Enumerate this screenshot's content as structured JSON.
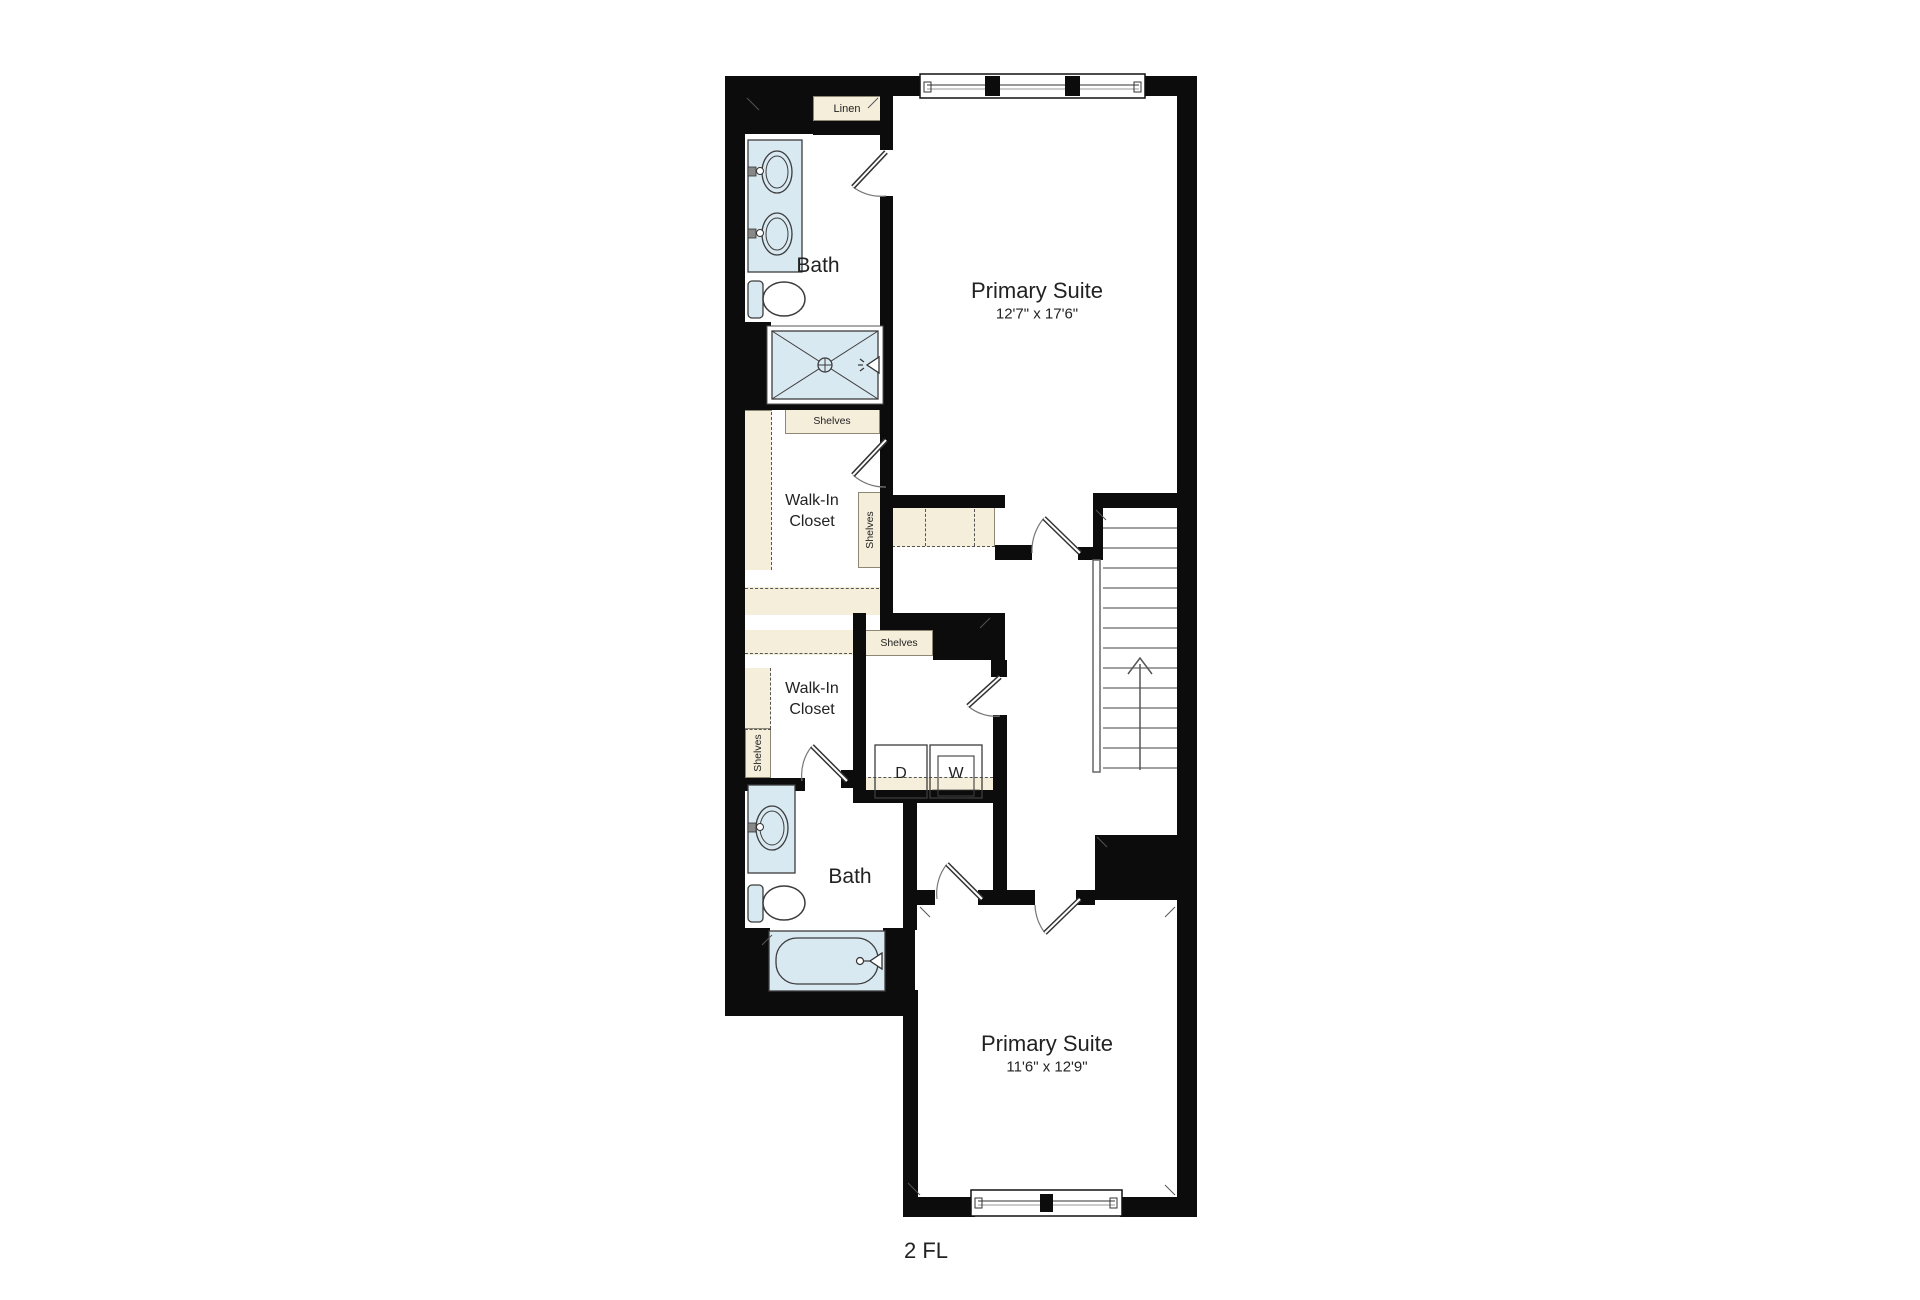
{
  "floor_label": "2 FL",
  "rooms": {
    "primary_suite_top": {
      "name": "Primary Suite",
      "dimensions": "12'7\" x 17'6\""
    },
    "primary_suite_bottom": {
      "name": "Primary Suite",
      "dimensions": "11'6\" x 12'9\""
    },
    "bath_top": {
      "name": "Bath"
    },
    "bath_bottom": {
      "name": "Bath"
    },
    "walk_in_closet_top": {
      "name": "Walk-In Closet"
    },
    "walk_in_closet_bottom": {
      "name": "Walk-In Closet"
    }
  },
  "labels": {
    "linen": "Linen",
    "shelves": "Shelves",
    "dryer": "D",
    "washer": "W"
  },
  "icons": {
    "stairs_direction": "up-arrow",
    "shower_head": "spray-left",
    "tub_faucet": "spray-left",
    "drain": "circle-cross"
  },
  "colors": {
    "wall": "#0c0c0c",
    "casework": "#f5eedb",
    "fixture_fill": "#d9e9f1",
    "background": "#ffffff"
  }
}
